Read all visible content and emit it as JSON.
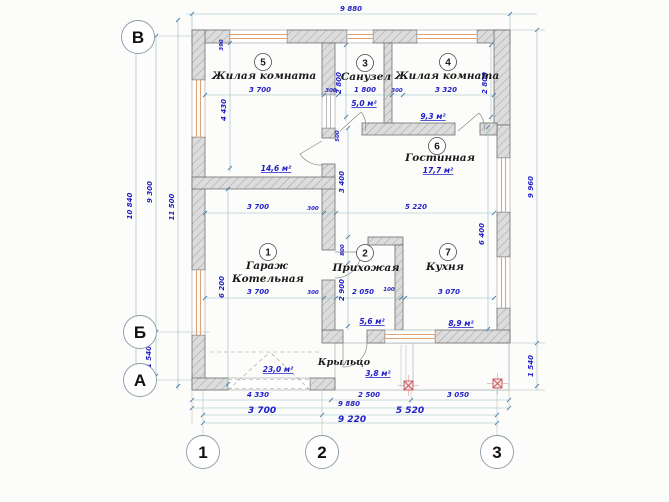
{
  "plan": {
    "rooms": {
      "r1": {
        "number": "1",
        "line1": "Гараж",
        "line2": "Котельная",
        "area": "23,0 м²"
      },
      "r2": {
        "number": "2",
        "name": "Прихожая",
        "area": "5,6 м²"
      },
      "r3": {
        "number": "3",
        "name": "Санузел",
        "area": "5,0 м²"
      },
      "r4": {
        "number": "4",
        "name": "Жилая комната",
        "area": "9,3 м²"
      },
      "r5": {
        "number": "5",
        "name": "Жилая комната",
        "area": "14,6 м²"
      },
      "r6": {
        "number": "6",
        "name": "Гостинная",
        "area": "17,7 м²"
      },
      "r7": {
        "number": "7",
        "name": "Кухня",
        "area": "8,9 м²"
      },
      "porch": {
        "name": "Крыльцо",
        "area": "3,8 м²"
      }
    },
    "axes": {
      "row_top": "В",
      "row_mid": "Б",
      "row_bot": "А",
      "col_1": "1",
      "col_2": "2",
      "col_3": "3"
    },
    "dims": {
      "top_total": "9 880",
      "r5_offset": "390",
      "r5_width": "3 700",
      "gap_a": "300",
      "bath_width": "1 800",
      "gap_b": "300",
      "r4_width": "3 320",
      "bath_depth": "2 800",
      "door_off": "500",
      "r4_depth": "2 800",
      "r5_height": "4 430",
      "garage_width": "3 700",
      "gap_c": "300",
      "living_width": "5 220",
      "living_height": "3 400",
      "stub_offset": "800",
      "hall_height": "2 900",
      "garage_height": "6 200",
      "kitchen_height": "6 400",
      "hall_width": "2 050",
      "gap_d": "100",
      "kitchen_width": "3 070",
      "gap_e": "300",
      "left_out": "10 840",
      "left_in": "9 300",
      "left_far": "11 500",
      "left_porch": "1 540",
      "right_total": "9 960",
      "right_porch": "1 540",
      "bot_seg1": "4 330",
      "bot_seg2": "2 500",
      "bot_seg3": "3 050",
      "bot_total": "9 880",
      "bot_ax12": "3 700",
      "bot_ax23": "5 520",
      "bot_ax13": "9 220"
    }
  },
  "colors": {
    "dim_text": "#1e1ec8",
    "dim_line": "#93bcbc",
    "wall_fill": "#dcdcdc",
    "window_frame": "#dfa273",
    "column_marker": "#c25252"
  }
}
